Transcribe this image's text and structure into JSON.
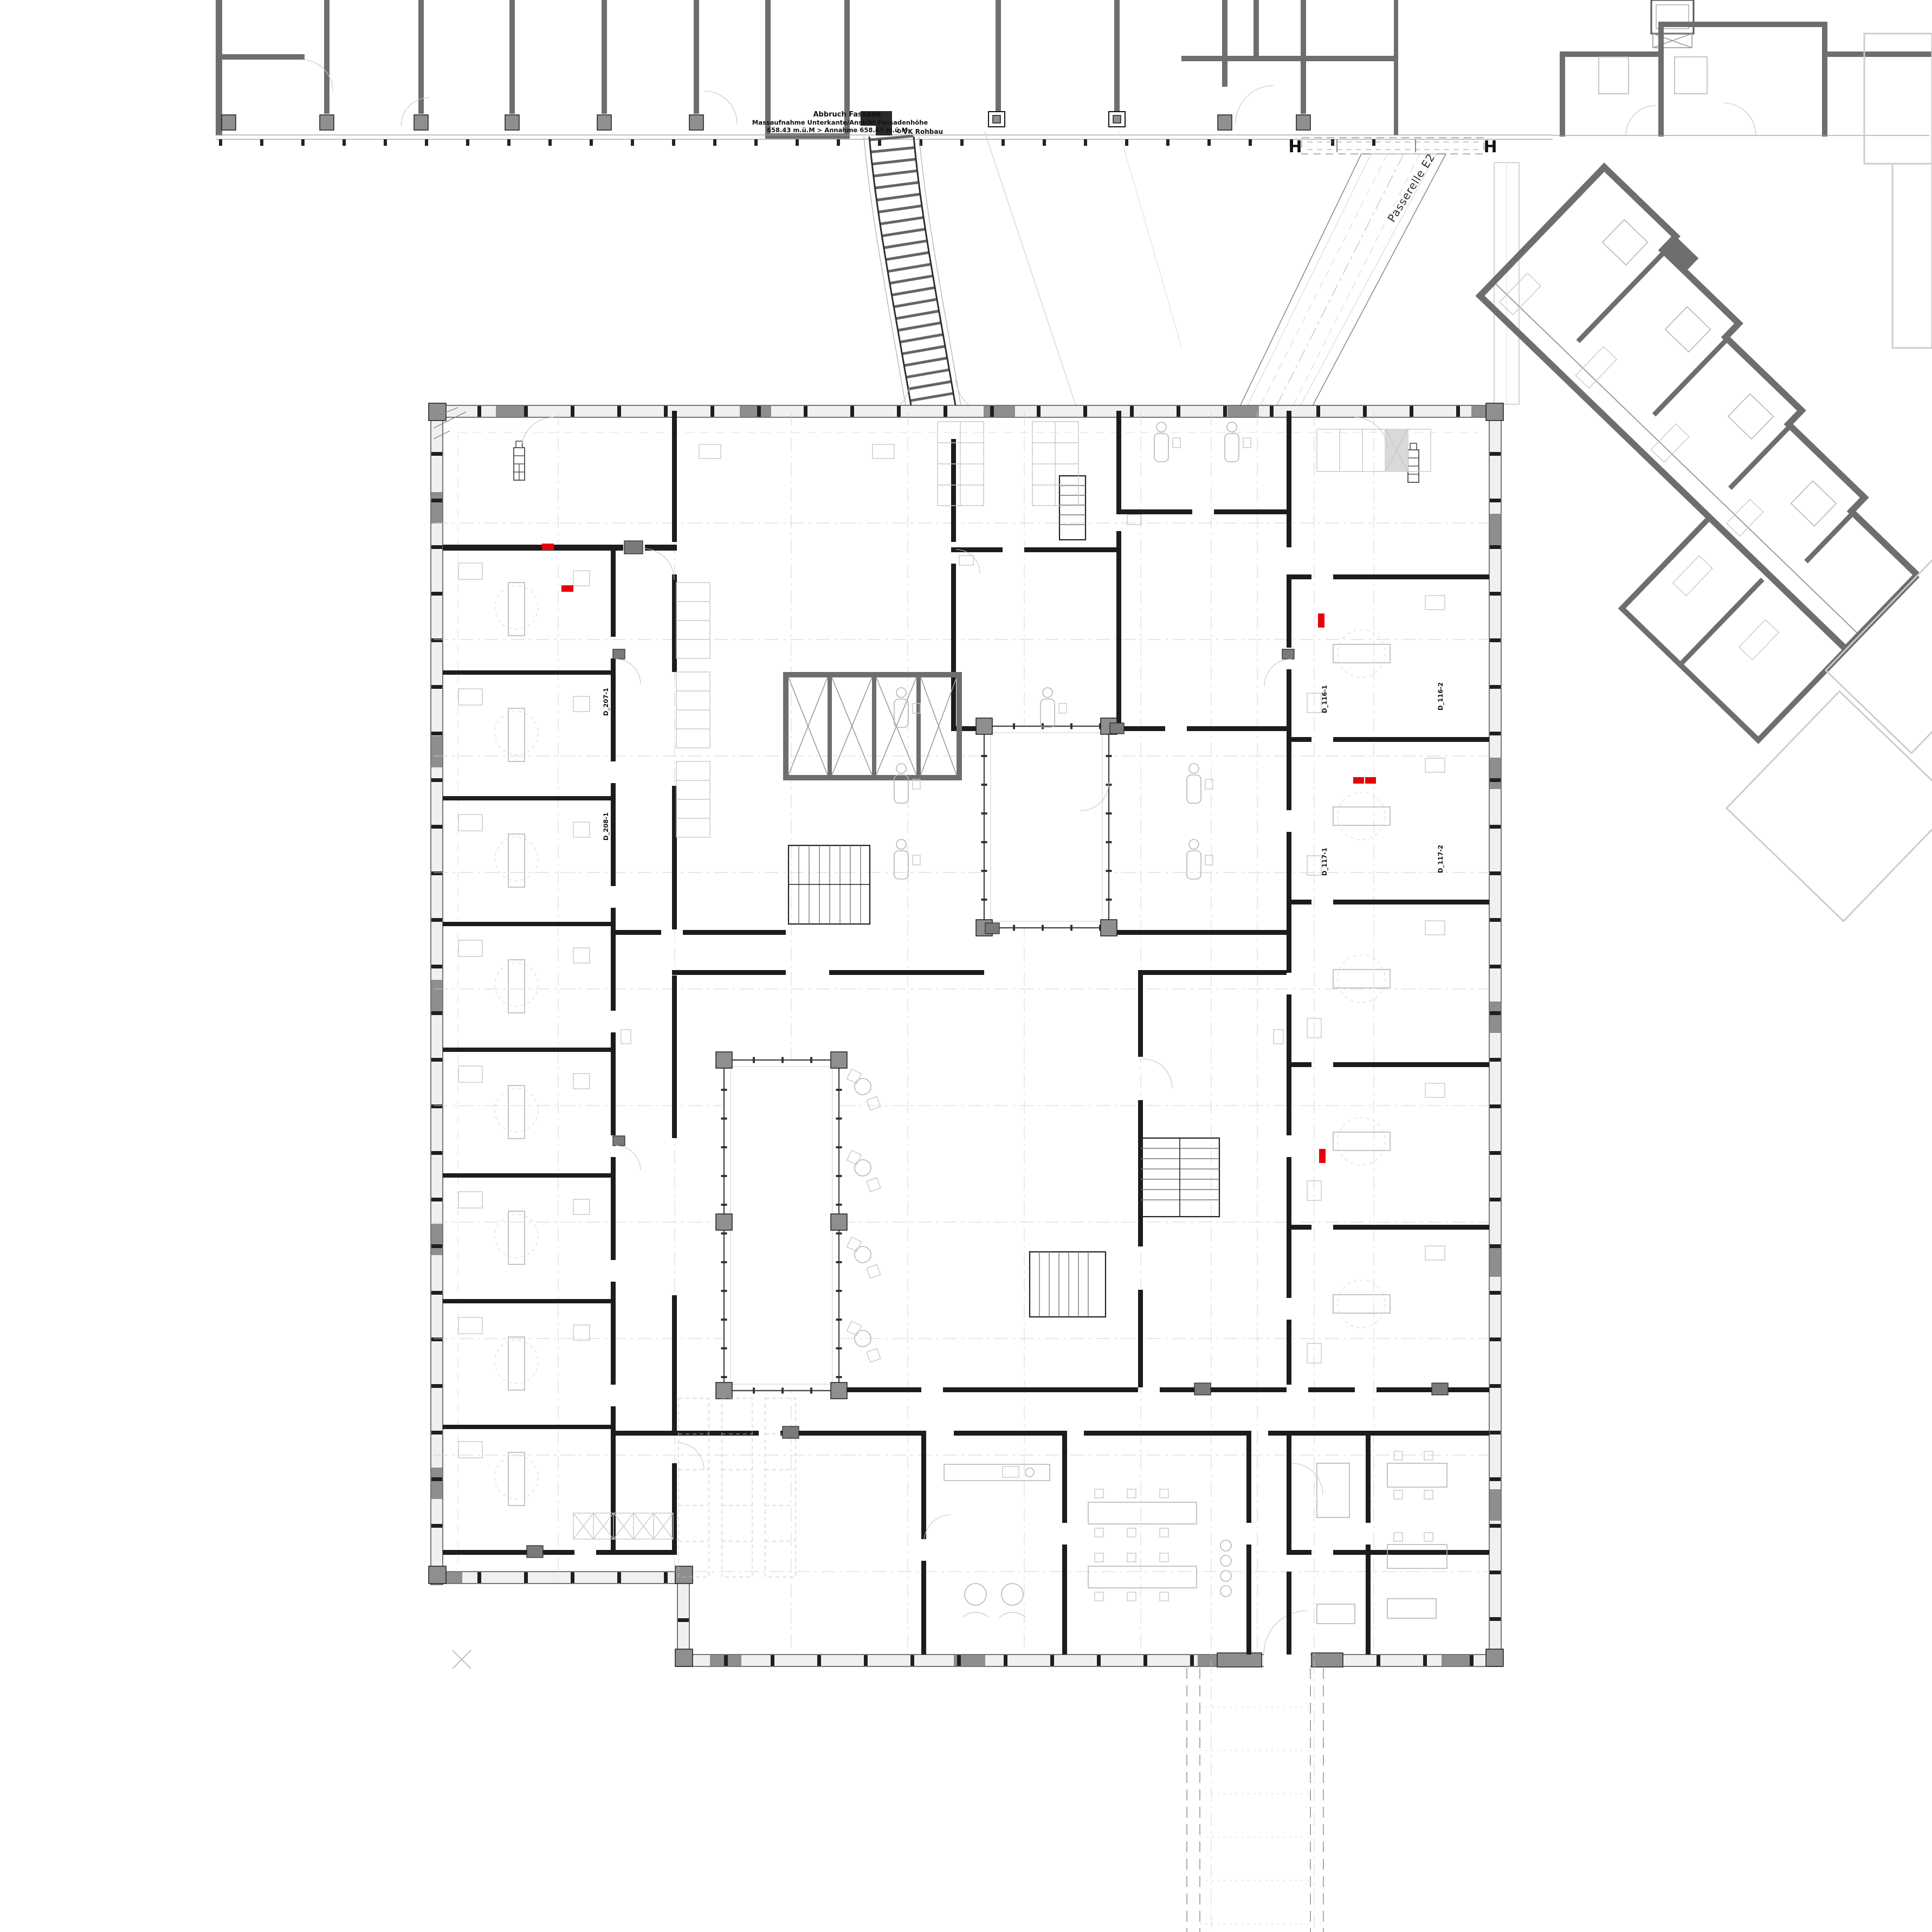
{
  "page": {
    "type": "architectural floor plan",
    "description": "Ground floor plan of a clinic building with existing north wing, angled east patient wing, two passerelle links and an underground corridor",
    "sheet_background": "#ffffff"
  },
  "annotations": {
    "abbruch": "Abbruch Fassade",
    "massaufnahme": "Massaufnahme Unterkante/Ansicht Fassadenhöhe",
    "level_note": "658.43 m.ü.M > Annahme 658.47 m.ü.M",
    "vk_rohbau": "VK Rohbau"
  },
  "passerelle": {
    "label": "Passerelle E2"
  },
  "markers": {
    "hydrant": "H"
  },
  "room_labels": {
    "right": [
      "D_116-1",
      "D_116-2",
      "D_117-1",
      "D_117-2"
    ],
    "left": [
      "D_207-1",
      "D_208-1"
    ]
  },
  "colors": {
    "wall_new": "#1c1c1c",
    "wall_existing": "#6e6e6e",
    "facade_fill": "#f0f0f0",
    "furniture": "#b5b5b5",
    "glass_frame": "#4a4a4a",
    "reference_grid": "#cfcfcf",
    "door_marker_red": "#e8000a",
    "canopy_gray": "#8e8e8e",
    "background": "#ffffff"
  }
}
